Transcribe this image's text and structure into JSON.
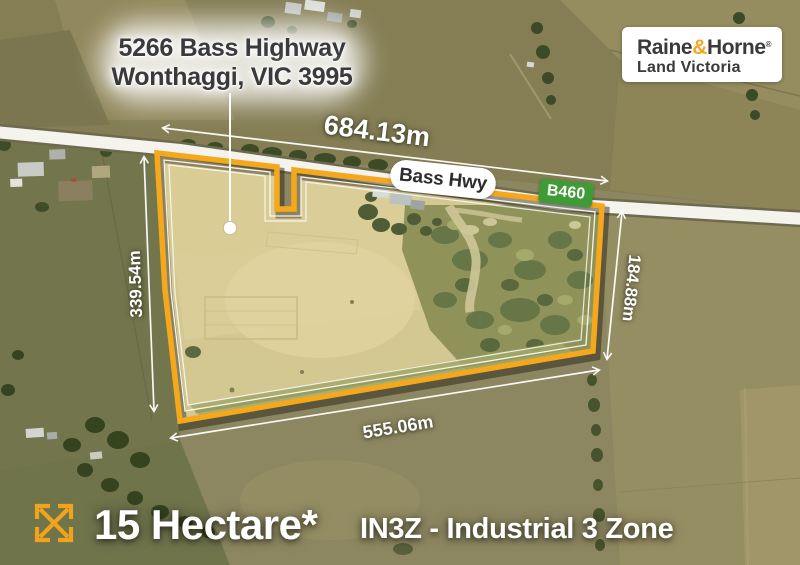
{
  "address": {
    "line1": "5266 Bass Highway",
    "line2": "Wonthaggi, VIC 3995"
  },
  "brand": {
    "raine": "Raine",
    "amp": "&",
    "horne": "Horne",
    "trademark": "®",
    "division": "Land Victoria"
  },
  "road": {
    "name": "Bass Hwy",
    "route_code": "B460"
  },
  "dimensions": {
    "top": "684.13m",
    "left": "339.54m",
    "right": "184.88m",
    "bottom": "555.06m"
  },
  "footer": {
    "area": "15 Hectare*",
    "zoning": "IN3Z - Industrial 3 Zone"
  },
  "colors": {
    "boundary": "#F6A81C",
    "route_badge": "#3F9B35",
    "brand_gold": "#F6A71F"
  }
}
